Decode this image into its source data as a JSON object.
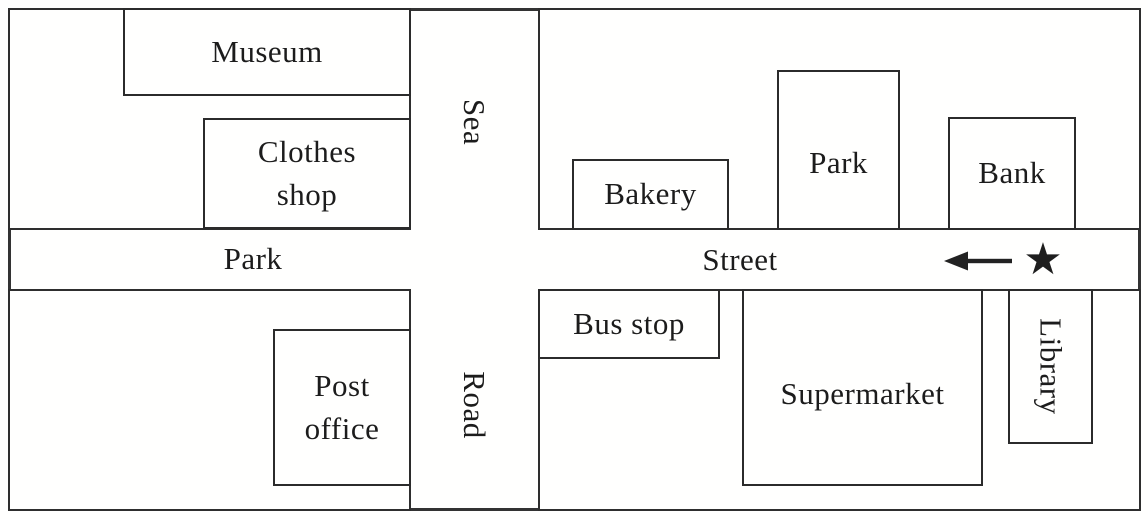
{
  "map": {
    "streets": {
      "horizontal_name_left": "Park",
      "horizontal_name_right": "Street",
      "vertical_name_top": "Sea",
      "vertical_name_bottom": "Road"
    },
    "buildings": {
      "museum": {
        "label": "Museum"
      },
      "clothes_shop": {
        "line1": "Clothes",
        "line2": "shop"
      },
      "bakery": {
        "label": "Bakery"
      },
      "park": {
        "label": "Park"
      },
      "bank": {
        "label": "Bank"
      },
      "post_office": {
        "line1": "Post",
        "line2": "office"
      },
      "bus_stop": {
        "label": "Bus stop"
      },
      "supermarket": {
        "label": "Supermarket"
      },
      "library": {
        "label": "Library"
      }
    },
    "marker": {
      "star_glyph": "★",
      "arrow_direction": "left"
    },
    "colors": {
      "line": "#2e2e2e",
      "background": "#fffffe",
      "text": "#1c1c1c"
    }
  }
}
